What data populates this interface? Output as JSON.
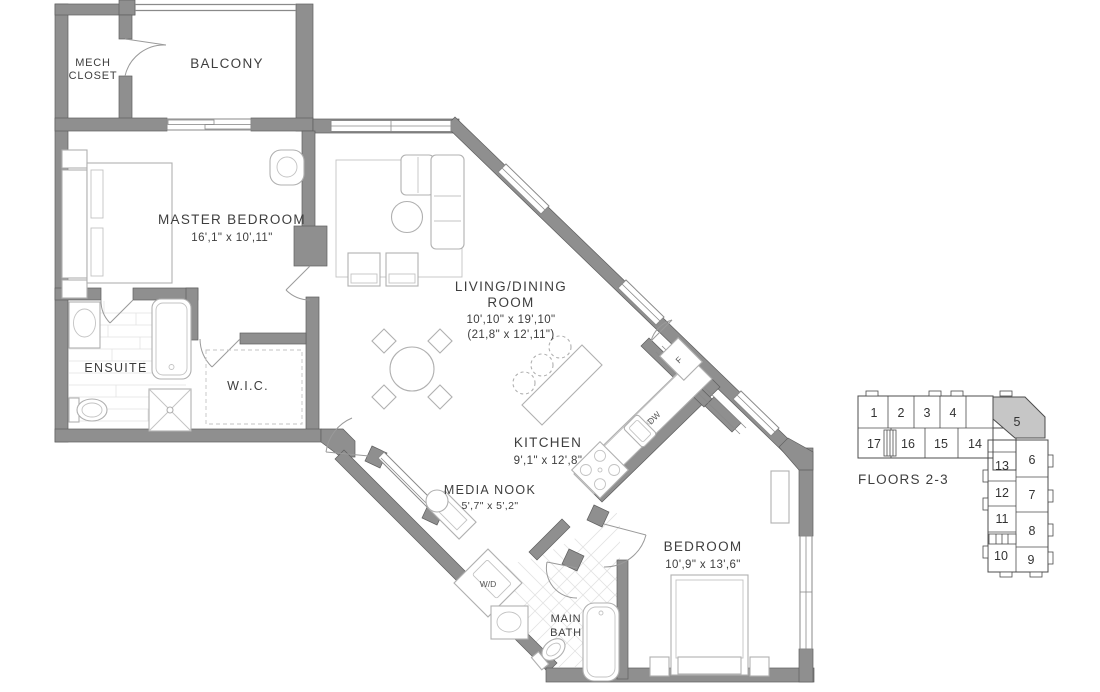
{
  "colors": {
    "wall": "#8f8f8f",
    "keyplan_highlight": "#c6c6c6",
    "text": "#3e3e3e"
  },
  "rooms": {
    "mech_closet": {
      "line1": "MECH",
      "line2": "CLOSET"
    },
    "balcony": {
      "name": "BALCONY"
    },
    "master_bedroom": {
      "name": "MASTER BEDROOM",
      "dims": "16',1\" x 10',11\""
    },
    "ensuite": {
      "name": "ENSUITE"
    },
    "wic": {
      "name": "W.I.C."
    },
    "living_dining": {
      "line1": "LIVING/DINING",
      "line2": "ROOM",
      "dims": "10',10\" x 19',10\"",
      "dims_alt": "(21,8\" x 12',11\")"
    },
    "kitchen": {
      "name": "KITCHEN",
      "dims": "9',1\" x 12',8\""
    },
    "media_nook": {
      "name": "MEDIA NOOK",
      "dims": "5',7\" x 5',2\""
    },
    "laundry": {
      "label": "W/D"
    },
    "main_bath": {
      "line1": "MAIN",
      "line2": "BATH"
    },
    "bedroom": {
      "name": "BEDROOM",
      "dims": "10',9\" x 13',6\""
    }
  },
  "appliances": {
    "dishwasher": "DW",
    "fridge": "F"
  },
  "keyplan": {
    "title": "FLOORS 2-3",
    "highlighted_unit": "5",
    "units": [
      "1",
      "2",
      "3",
      "4",
      "5",
      "17",
      "16",
      "15",
      "14",
      "13",
      "6",
      "12",
      "7",
      "11",
      "8",
      "10",
      "9"
    ]
  }
}
